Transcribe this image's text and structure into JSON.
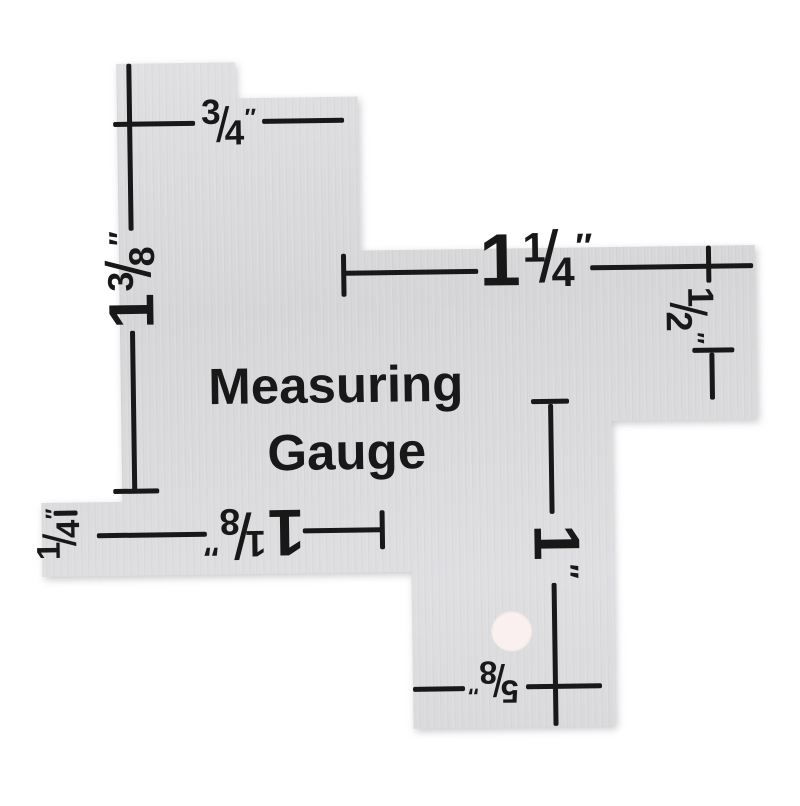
{
  "title": {
    "line1": "Measuring",
    "line2": "Gauge"
  },
  "measurements": {
    "top_edge": {
      "whole": "",
      "num": "3",
      "slash": "/",
      "den": "4",
      "unit": "″",
      "value": "3/4 inch"
    },
    "left_edge": {
      "whole": "1",
      "num": "3",
      "slash": "/",
      "den": "8",
      "unit": "″",
      "value": "1 3/8 inch"
    },
    "right_arm": {
      "whole": "1",
      "num": "1",
      "slash": "/",
      "den": "4",
      "unit": "″",
      "value": "1 1/4 inch"
    },
    "right_side": {
      "whole": "",
      "num": "1",
      "slash": "/",
      "den": "2",
      "unit": "″",
      "value": "1/2 inch"
    },
    "bottom_left": {
      "whole": "",
      "num": "1",
      "slash": "/",
      "den": "4",
      "unit": "″",
      "value": "1/4 inch"
    },
    "bottom_center": {
      "whole": "1",
      "num": "1",
      "slash": "/",
      "den": "8",
      "unit": "″",
      "value": "1 1/8 inch"
    },
    "foot_vertical": {
      "whole": "1",
      "num": "",
      "slash": "",
      "den": "",
      "unit": "″",
      "value": "1 inch"
    },
    "foot_bottom": {
      "whole": "",
      "num": "5",
      "slash": "/",
      "den": "8",
      "unit": "″",
      "value": "5/8 inch"
    }
  },
  "colors": {
    "background": "#ffffff",
    "plate": "#d9d9db",
    "ink": "#181818",
    "hole": "#f9f0ef"
  }
}
